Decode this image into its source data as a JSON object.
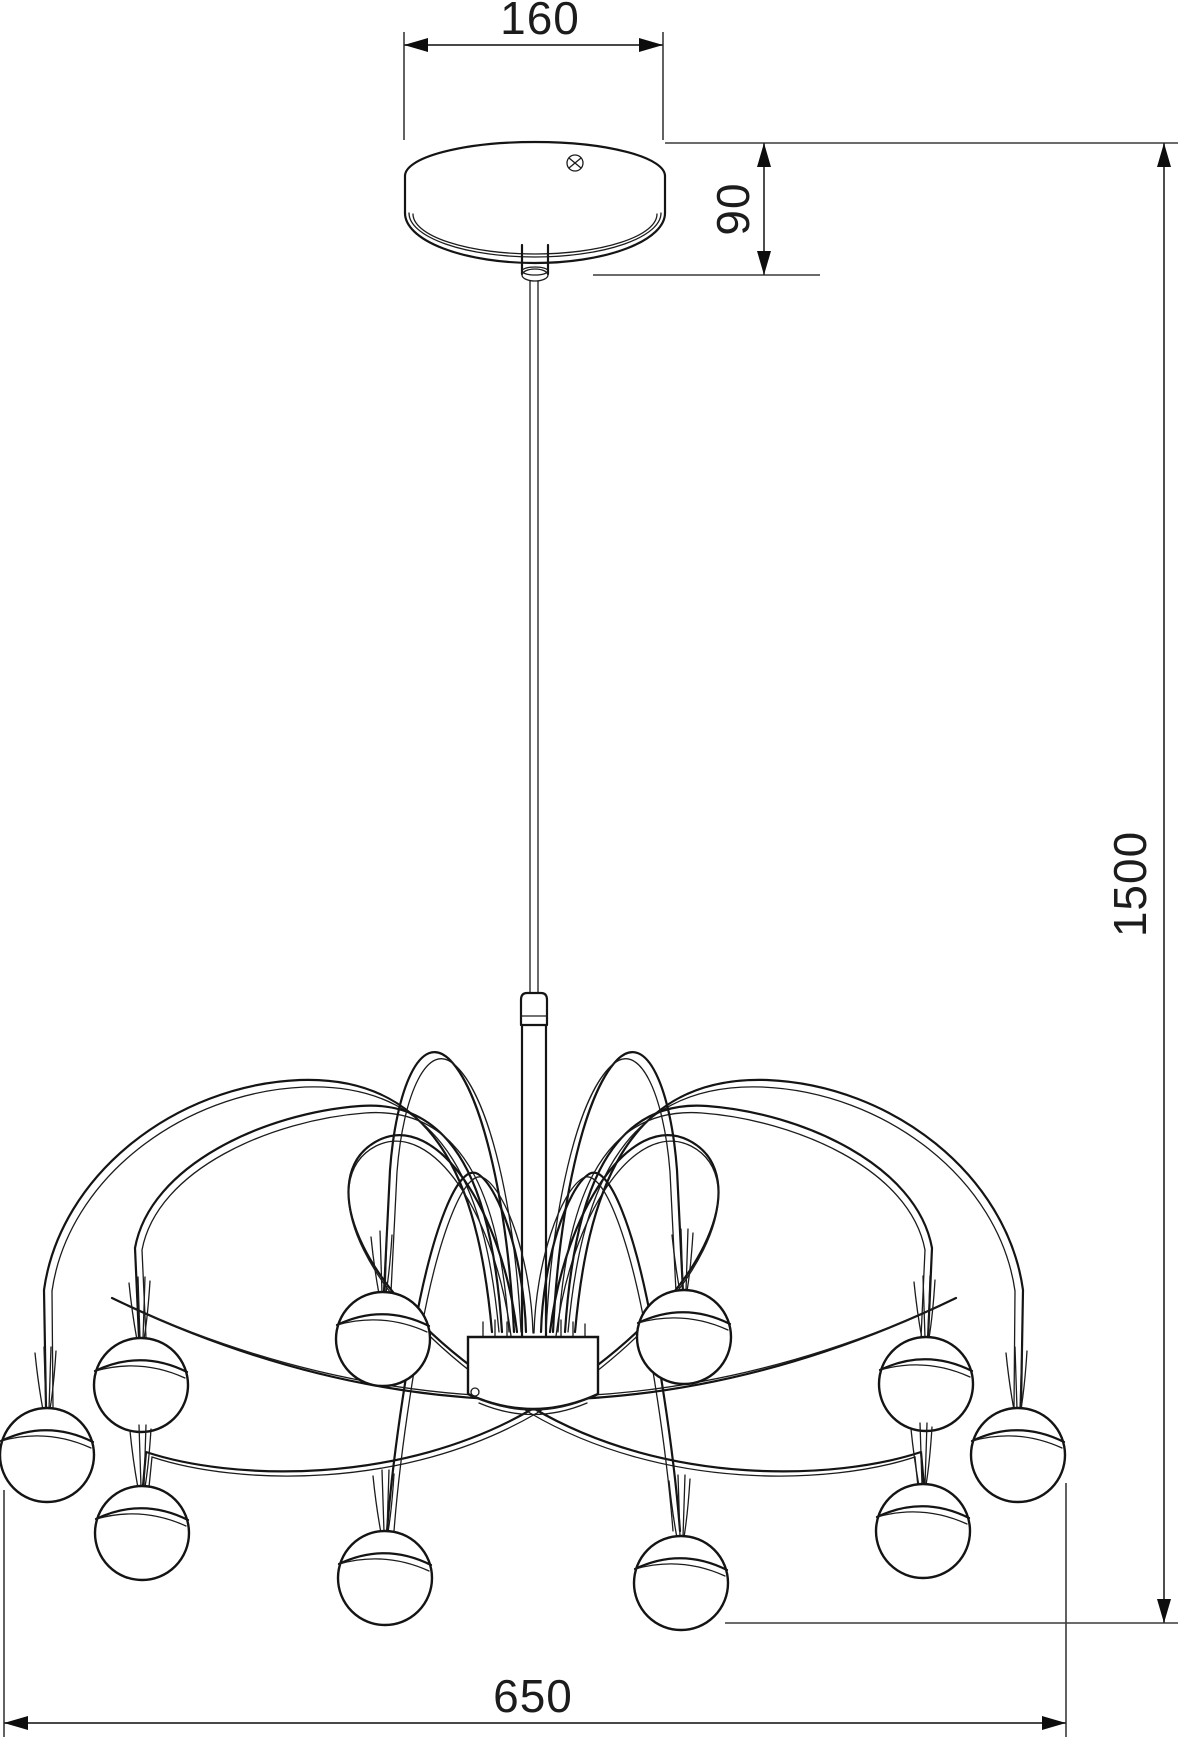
{
  "drawing": {
    "type": "technical-dimension-drawing",
    "subject": "pendant spider chandelier with 10 ball lamps, ceiling canopy and suspension cable"
  },
  "dimensions": {
    "canopy_diameter_mm": "160",
    "canopy_height_mm": "90",
    "suspension_height_mm": "1500",
    "fixture_diameter_mm": "650"
  },
  "counts": {
    "lamp_balls": 10
  },
  "colors": {
    "background": "#ffffff",
    "fixture_line": "#141414",
    "dimension_line": "#2e2e2e",
    "text": "#1c1c1c"
  }
}
